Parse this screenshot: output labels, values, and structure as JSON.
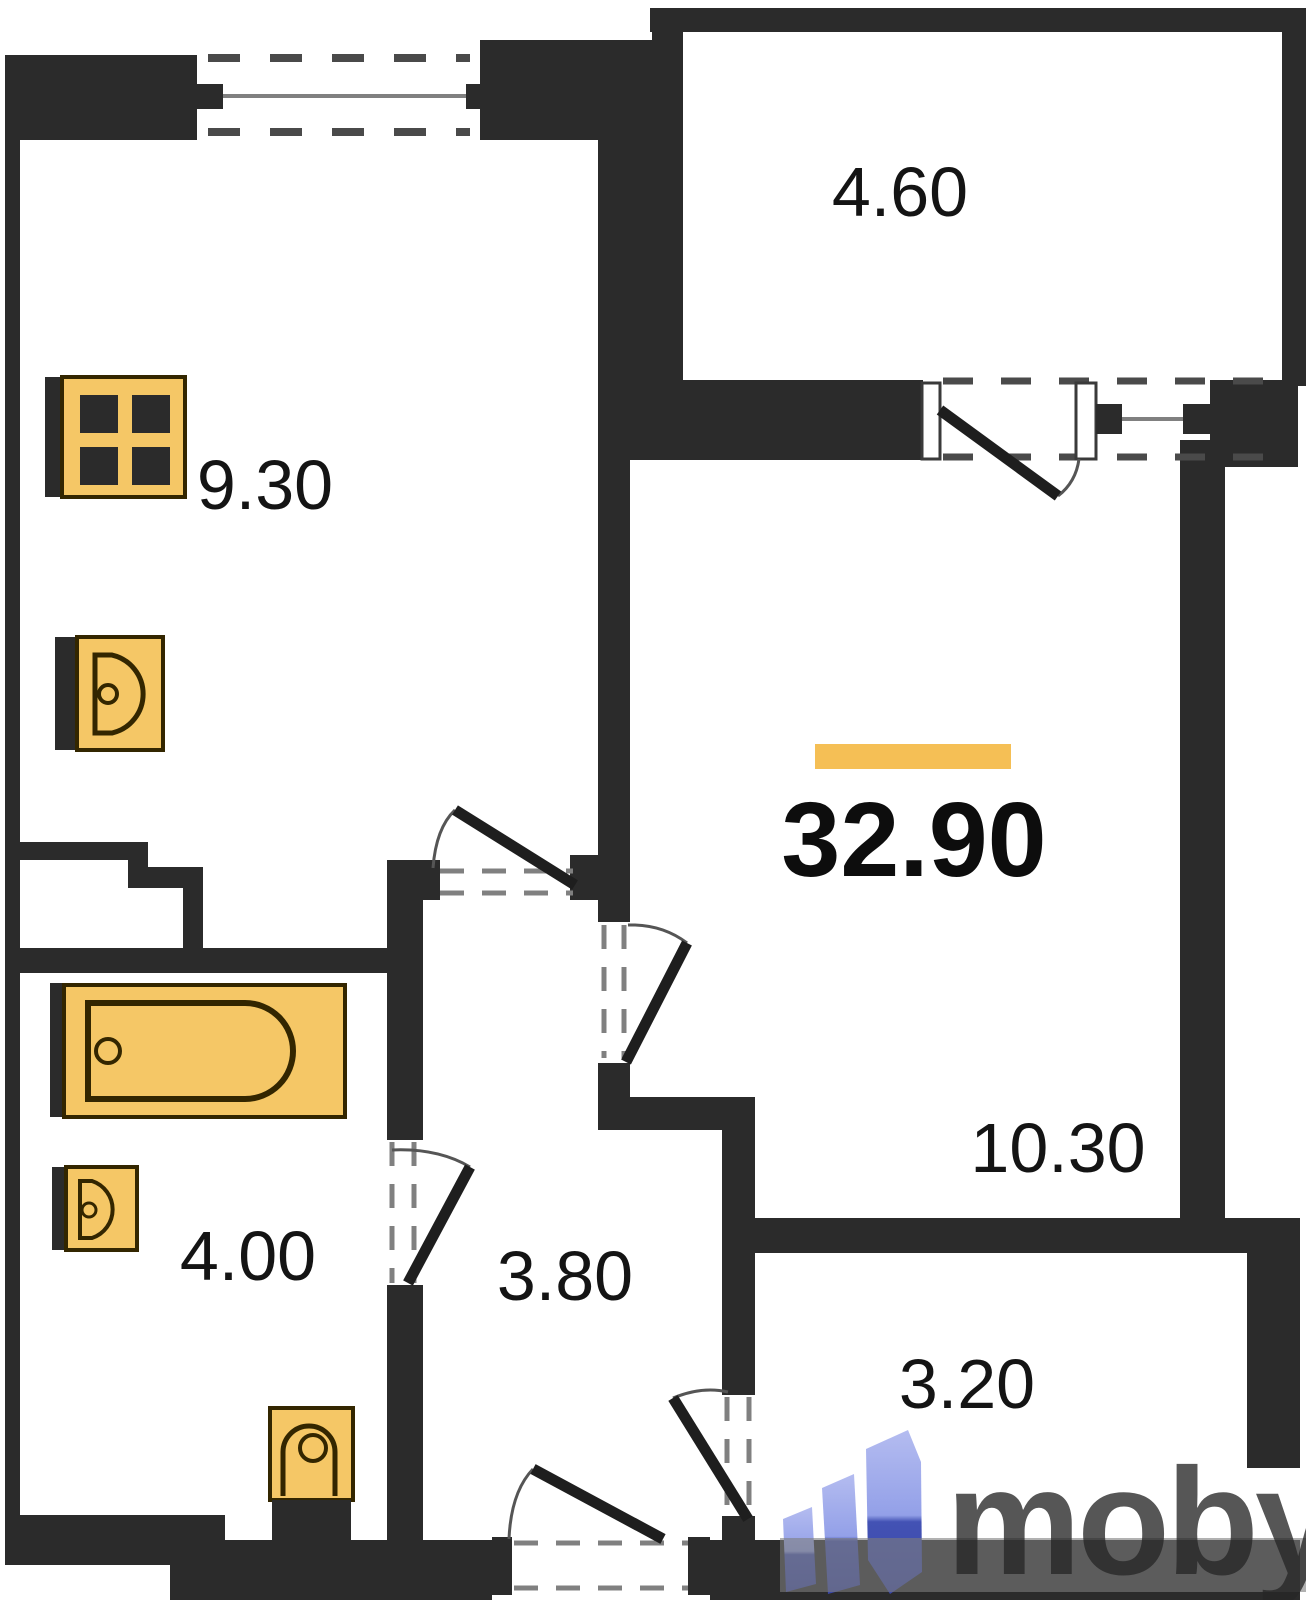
{
  "floorplan": {
    "total_area": "32.90",
    "highlight_color": "#F5BF55",
    "wall_color": "#2B2B2B",
    "fixture_color": "#F5C766",
    "rooms": [
      {
        "id": "kitchen",
        "area": "9.30"
      },
      {
        "id": "balcony-top",
        "area": "4.60"
      },
      {
        "id": "living-room",
        "area": "10.30"
      },
      {
        "id": "bathroom",
        "area": "4.00"
      },
      {
        "id": "hallway",
        "area": "3.80"
      },
      {
        "id": "balcony-bottom",
        "area": "3.20"
      }
    ]
  },
  "watermark": {
    "brand": "moby",
    "logo_color_light": "#A9B4EC",
    "logo_color_dark": "#3D4CAE",
    "band_color": "rgba(125,125,125,0.6)"
  }
}
